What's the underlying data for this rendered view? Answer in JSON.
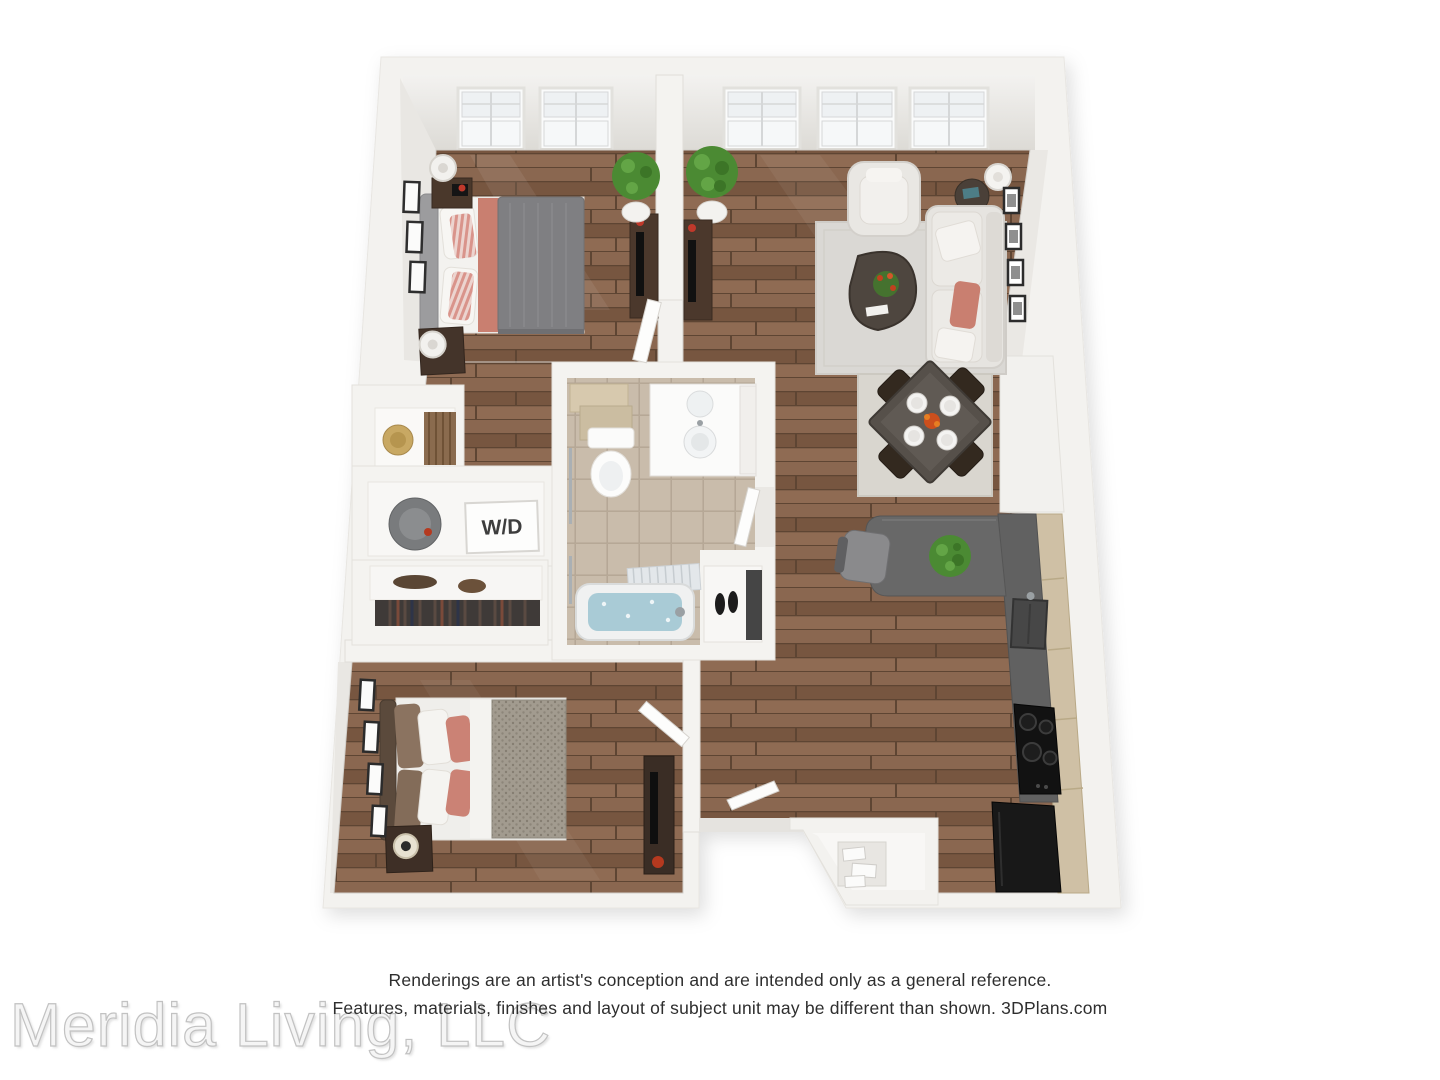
{
  "floorplan": {
    "description": "3D birds-eye rendering of a two-bedroom, one-bath apartment floor plan",
    "labels": {
      "washer_dryer": "W/D"
    },
    "rooms": [
      "bedroom-1",
      "living-room",
      "dining-area",
      "kitchen",
      "bathroom",
      "bedroom-2",
      "entry",
      "walk-in-closets",
      "laundry-closet"
    ],
    "windows": {
      "bedroom_1": 2,
      "living_room": 3
    },
    "palette": {
      "wall": "#f3f2ef",
      "wood_floor": "#7e5d47",
      "tile_floor": "#c9bcab",
      "counter": "#616161",
      "cabinet": "#cfc0a5",
      "accent_coral": "#c97f70",
      "sofa": "#e6e4e0",
      "appliance": "#161616",
      "plant": "#4b8a33",
      "water": "#a9cbd6"
    }
  },
  "footer": {
    "disclaimer_line1": "Renderings are an artist's conception and are intended only as a general reference.",
    "disclaimer_line2": "Features, materials, finishes and layout of subject unit may be different than shown. 3DPlans.com",
    "watermark": "Meridia Living, LLC"
  }
}
